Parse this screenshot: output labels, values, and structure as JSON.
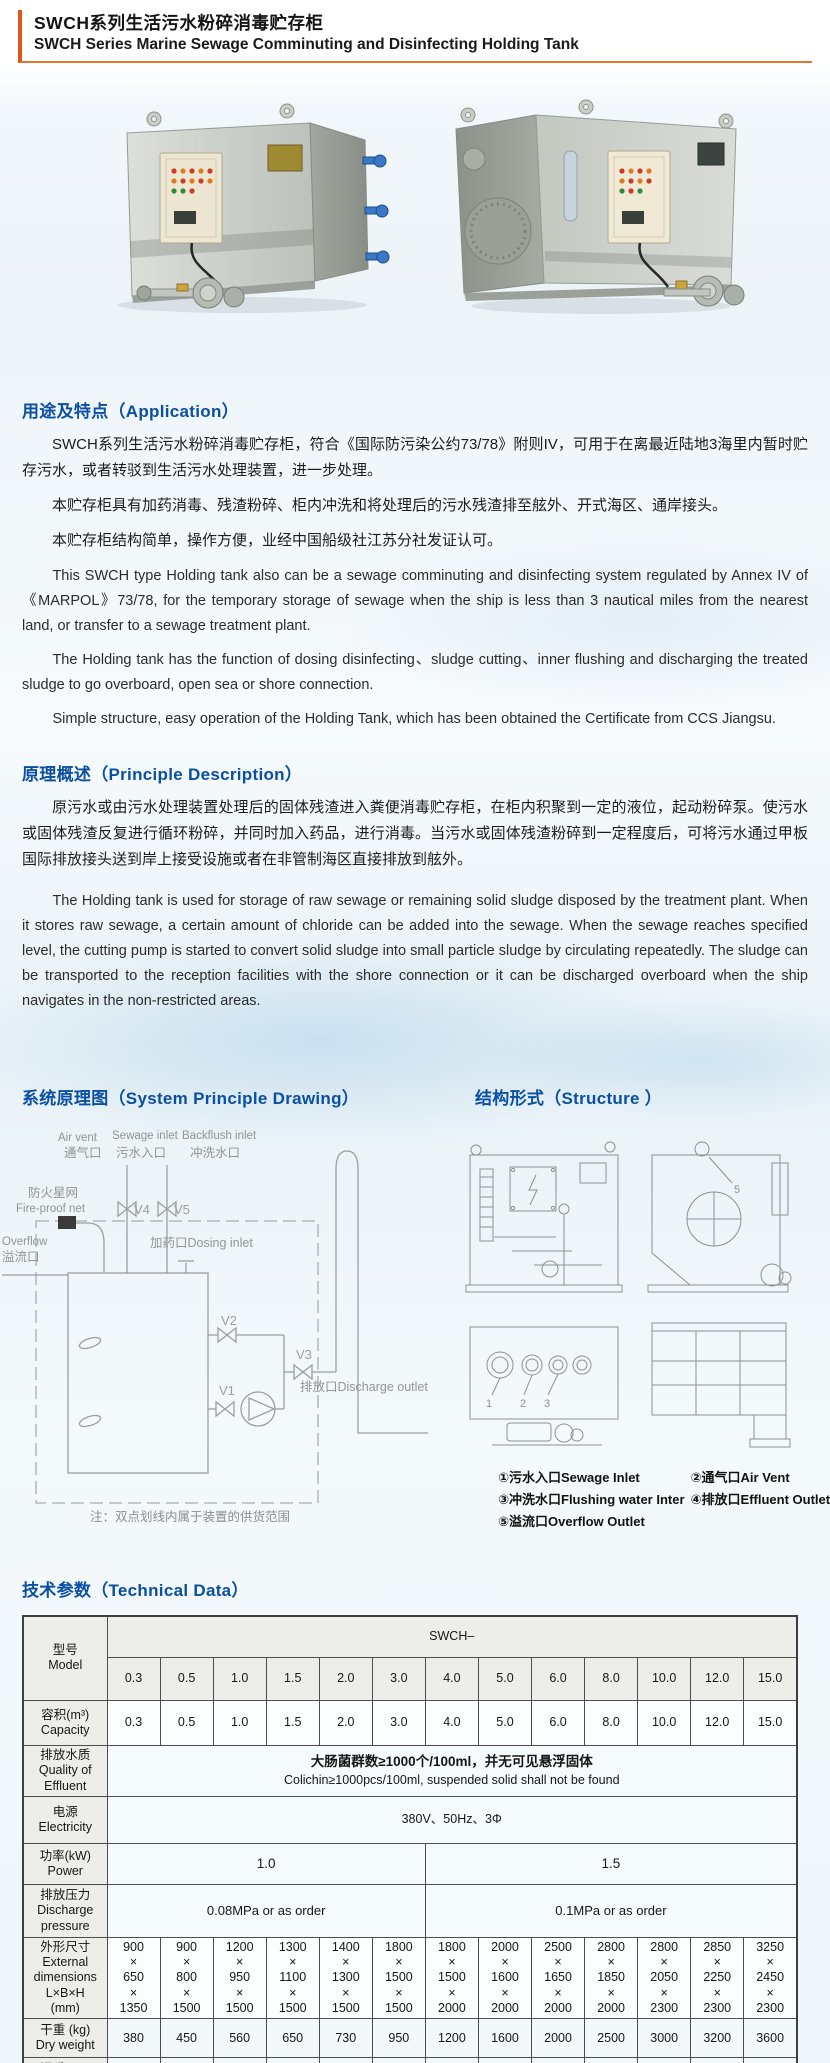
{
  "title": {
    "zh": "SWCH系列生活污水粉碎消毒贮存柜",
    "en": "SWCH Series Marine Sewage Comminuting and Disinfecting Holding Tank"
  },
  "application": {
    "heading": "用途及特点（Application）",
    "paragraphs_zh": [
      "SWCH系列生活污水粉碎消毒贮存柜，符合《国际防污染公约73/78》附则IV，可用于在离最近陆地3海里内暂时贮存污水，或者转驳到生活污水处理装置，进一步处理。",
      "本贮存柜具有加药消毒、残渣粉碎、柜内冲洗和将处理后的污水残渣排至舷外、开式海区、通岸接头。",
      "本贮存柜结构简单，操作方便，业经中国船级社江苏分社发证认可。"
    ],
    "paragraphs_en": [
      "This SWCH type Holding tank also can be a sewage comminuting and disinfecting system regulated by Annex IV of 《MARPOL》73/78, for the temporary storage of sewage when the ship is less than 3 nautical miles from the nearest land, or transfer to a sewage treatment plant.",
      "The Holding tank has the function of dosing disinfecting、sludge cutting、inner flushing and discharging the treated sludge to go overboard, open sea or shore connection.",
      "Simple structure, easy operation of the Holding Tank, which has been obtained the Certificate from CCS Jiangsu."
    ]
  },
  "principle": {
    "heading": "原理概述（Principle Description）",
    "paragraph_zh": "原污水或由污水处理装置处理后的固体残渣进入粪便消毒贮存柜，在柜内积聚到一定的液位，起动粉碎泵。使污水或固体残渣反复进行循环粉碎，并同时加入药品，进行消毒。当污水或固体残渣粉碎到一定程度后，可将污水通过甲板国际排放接头送到岸上接受设施或者在非管制海区直接排放到舷外。",
    "paragraph_en": "The Holding tank is used for storage of raw sewage or remaining solid sludge disposed by the treatment plant. When it stores raw sewage, a certain amount of chloride can be added into the sewage. When the sewage reaches specified level, the cutting pump is started to convert solid sludge into small particle sludge by circulating repeatedly. The sludge can be transported to the reception facilities with the shore connection or it can be discharged overboard when the ship navigates in the non-restricted areas."
  },
  "system_drawing": {
    "heading": "系统原理图（System Principle Drawing）",
    "labels": {
      "air_vent_en": "Air vent",
      "air_vent_zh": "通气口",
      "sewage_en": "Sewage inlet",
      "sewage_zh": "污水入口",
      "backflush_en": "Backflush inlet",
      "backflush_zh": "冲洗水口",
      "fireproof_zh": "防火星网",
      "fireproof_en": "Fire-proof net",
      "overflow_en": "Overflow",
      "overflow_zh": "溢流口",
      "dosing": "加药口Dosing inlet",
      "discharge": "排放口Discharge outlet",
      "v1": "V1",
      "v2": "V2",
      "v3": "V3",
      "v4": "V4",
      "v5": "V5"
    },
    "note": "注：双点划线内属于装置的供货范围"
  },
  "structure": {
    "heading": "结构形式（Structure ）",
    "view_label_5": "5",
    "view_labels_bottom": [
      "1",
      "2",
      "3"
    ],
    "legend": [
      "①污水入口Sewage Inlet",
      "②通气口Air Vent",
      "③冲洗水口Flushing water Inter",
      "④排放口Effluent Outlet",
      "⑤溢流口Overflow Outlet"
    ]
  },
  "tech": {
    "heading": "技术参数（Technical Data）",
    "series_label": "SWCH–",
    "model_label": "型号\nModel",
    "models": [
      "0.3",
      "0.5",
      "1.0",
      "1.5",
      "2.0",
      "3.0",
      "4.0",
      "5.0",
      "6.0",
      "8.0",
      "10.0",
      "12.0",
      "15.0"
    ],
    "capacity_label": "容积(m³)\nCapacity",
    "capacity": [
      "0.3",
      "0.5",
      "1.0",
      "1.5",
      "2.0",
      "3.0",
      "4.0",
      "5.0",
      "6.0",
      "8.0",
      "10.0",
      "12.0",
      "15.0"
    ],
    "quality_label": "排放水质\nQuality of\nEffluent",
    "quality_zh": "大肠菌群数≥1000个/100ml，并无可见悬浮固体",
    "quality_en": "Colichin≥1000pcs/100ml, suspended solid shall not be found",
    "electricity_label": "电源\nElectricity",
    "electricity_value": "380V、50Hz、3Φ",
    "power_label": "功率(kW)\nPower",
    "power_values": [
      "1.0",
      "1.5"
    ],
    "pressure_label": "排放压力\nDischarge\npressure",
    "pressure_values": [
      "0.08MPa or as order",
      "0.1MPa or as order"
    ],
    "dims_label": "外形尺寸\nExternal\ndimensions\nL×B×H\n(mm)",
    "dims": [
      "900\n×\n650\n×\n1350",
      "900\n×\n800\n×\n1500",
      "1200\n×\n950\n×\n1500",
      "1300\n×\n1100\n×\n1500",
      "1400\n×\n1300\n×\n1500",
      "1800\n×\n1500\n×\n1500",
      "1800\n×\n1500\n×\n2000",
      "2000\n×\n1600\n×\n2000",
      "2500\n×\n1650\n×\n2000",
      "2800\n×\n1850\n×\n2000",
      "2800\n×\n2050\n×\n2300",
      "2850\n×\n2250\n×\n2300",
      "3250\n×\n2450\n×\n2300"
    ],
    "dry_label": "干重 (kg)\nDry weight",
    "dry_weight": [
      "380",
      "450",
      "560",
      "650",
      "730",
      "950",
      "1200",
      "1600",
      "2000",
      "2500",
      "3000",
      "3200",
      "3600"
    ],
    "wet_label": "湿重 (kg)\nWet weight",
    "wet_weight": [
      "680",
      "950",
      "1560",
      "2150",
      "2730",
      "3950",
      "5200",
      "6600",
      "8000",
      "10500",
      "13000",
      "15200",
      "18600"
    ]
  }
}
